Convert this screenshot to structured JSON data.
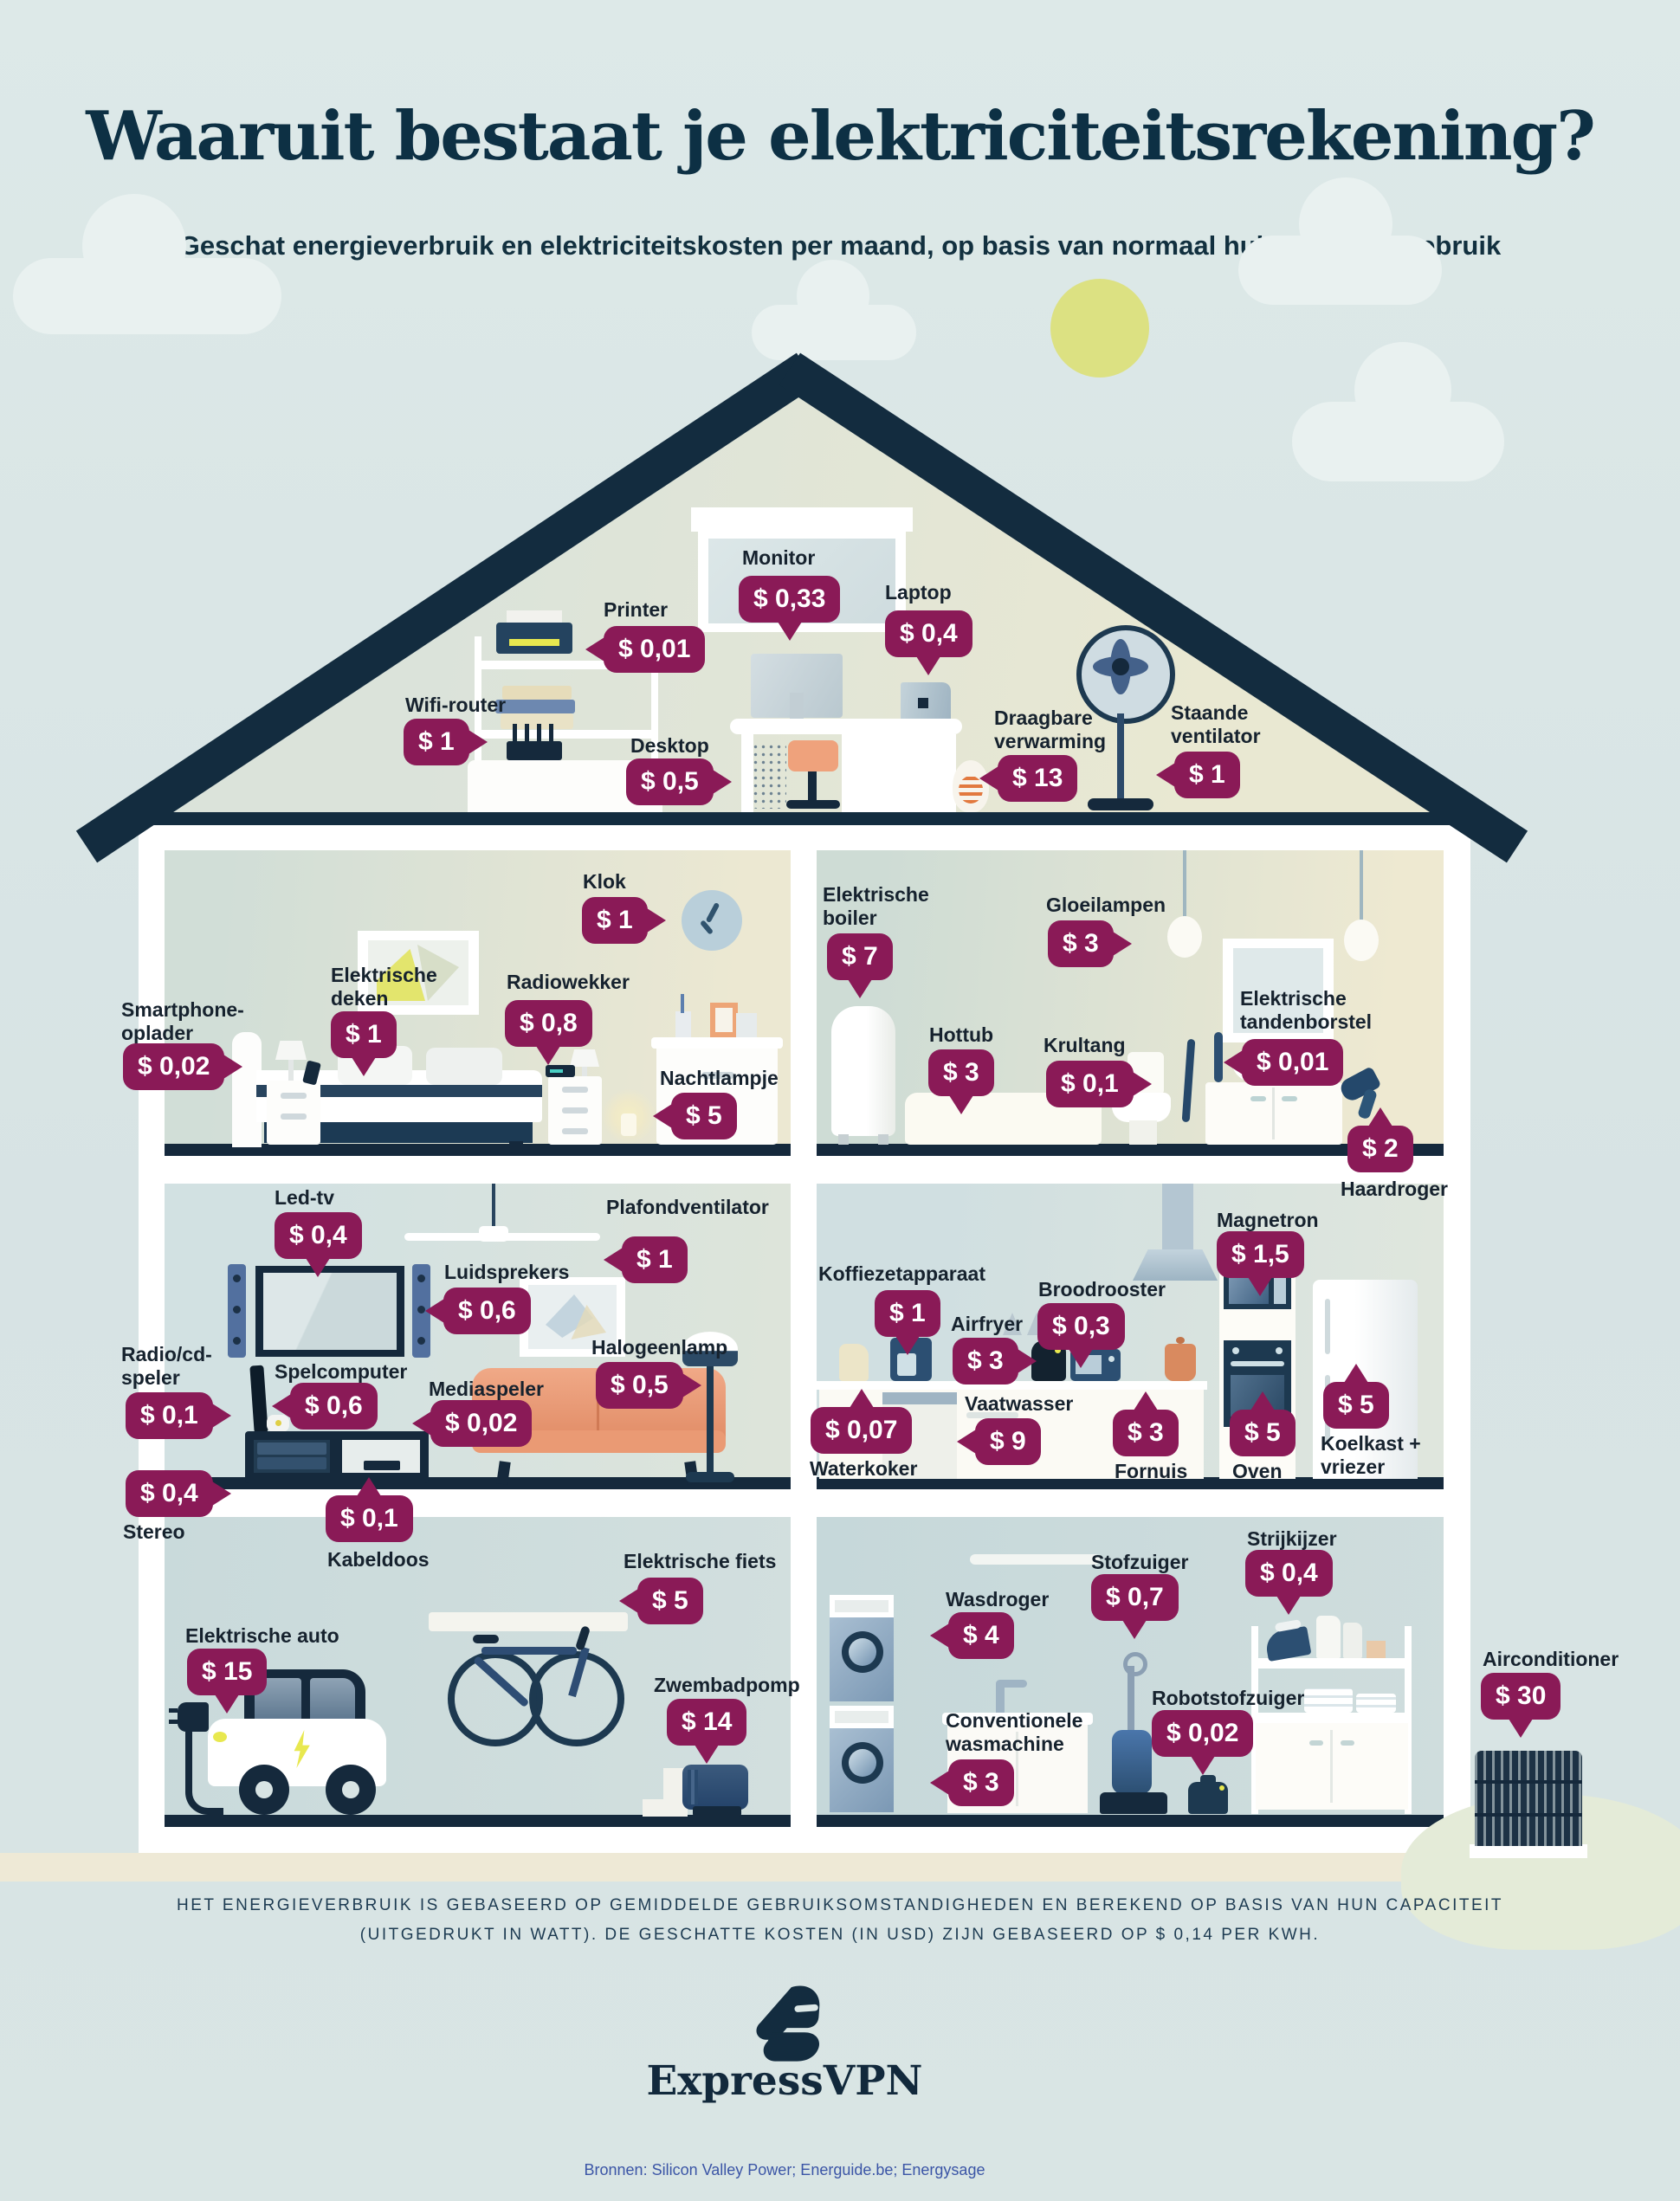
{
  "title": "Waaruit bestaat je elektriciteitsrekening?",
  "subtitle": "Geschat energieverbruik en elektriciteitskosten per maand, op basis van normaal huishoudelijk gebruik",
  "colors": {
    "badge": "#8a1a57",
    "roof_navy": "#15293c",
    "sun": "#dce182",
    "title": "#0d3044",
    "sources_blue": "#3b55a6"
  },
  "appliances": [
    {
      "label": "Printer",
      "price": "$ 0,01"
    },
    {
      "label": "Monitor",
      "price": "$ 0,33"
    },
    {
      "label": "Laptop",
      "price": "$ 0,4"
    },
    {
      "label": "Wifi-router",
      "price": "$ 1"
    },
    {
      "label": "Desktop",
      "price": "$ 0,5"
    },
    {
      "label": "Draagbare\nverwarming",
      "price": "$ 13"
    },
    {
      "label": "Staande\nventilator",
      "price": "$ 1"
    },
    {
      "label": "Klok",
      "price": "$ 1"
    },
    {
      "label": "Elektrische\ndeken",
      "price": "$ 1"
    },
    {
      "label": "Radiowekker",
      "price": "$ 0,8"
    },
    {
      "label": "Smartphone-\noplader",
      "price": "$ 0,02"
    },
    {
      "label": "Nachtlampje",
      "price": "$ 5"
    },
    {
      "label": "Elektrische\nboiler",
      "price": "$ 7"
    },
    {
      "label": "Gloeilampen",
      "price": "$ 3"
    },
    {
      "label": "Hottub",
      "price": "$ 3"
    },
    {
      "label": "Krultang",
      "price": "$ 0,1"
    },
    {
      "label": "Elektrische\ntandenborstel",
      "price": "$ 0,01"
    },
    {
      "label": "Haardroger",
      "price": "$ 2"
    },
    {
      "label": "Led-tv",
      "price": "$ 0,4"
    },
    {
      "label": "Plafondventilator",
      "price": "$ 1"
    },
    {
      "label": "Luidsprekers",
      "price": "$ 0,6"
    },
    {
      "label": "Halogeenlamp",
      "price": "$ 0,5"
    },
    {
      "label": "Radio/cd-\nspeler",
      "price": "$ 0,1"
    },
    {
      "label": "Spelcomputer",
      "price": "$ 0,6"
    },
    {
      "label": "Mediaspeler",
      "price": "$ 0,02"
    },
    {
      "label": "Stereo",
      "price": "$ 0,4"
    },
    {
      "label": "Kabeldoos",
      "price": "$ 0,1"
    },
    {
      "label": "Koffiezetapparaat",
      "price": "$ 1"
    },
    {
      "label": "Broodrooster",
      "price": "$ 0,3"
    },
    {
      "label": "Magnetron",
      "price": "$ 1,5"
    },
    {
      "label": "Airfryer",
      "price": "$ 3"
    },
    {
      "label": "Waterkoker",
      "price": "$ 0,07"
    },
    {
      "label": "Vaatwasser",
      "price": "$ 9"
    },
    {
      "label": "Fornuis",
      "price": "$ 3"
    },
    {
      "label": "Oven",
      "price": "$ 5"
    },
    {
      "label": "Koelkast +\nvriezer",
      "price": "$ 5"
    },
    {
      "label": "Elektrische auto",
      "price": "$ 15"
    },
    {
      "label": "Elektrische fiets",
      "price": "$ 5"
    },
    {
      "label": "Zwembadpomp",
      "price": "$ 14"
    },
    {
      "label": "Wasdroger",
      "price": "$ 4"
    },
    {
      "label": "Stofzuiger",
      "price": "$ 0,7"
    },
    {
      "label": "Strijkijzer",
      "price": "$ 0,4"
    },
    {
      "label": "Conventionele\nwasmachine",
      "price": "$ 3"
    },
    {
      "label": "Robotstofzuiger",
      "price": "$ 0,02"
    },
    {
      "label": "Airconditioner",
      "price": "$ 30"
    }
  ],
  "footer": {
    "disclaimer_line1": "HET ENERGIEVERBRUIK IS GEBASEERD OP GEMIDDELDE GEBRUIKSOMSTANDIGHEDEN EN BEREKEND OP BASIS VAN HUN CAPACITEIT",
    "disclaimer_line2": "(UITGEDRUKT IN WATT). DE GESCHATTE KOSTEN (IN USD) ZIJN GEBASEERD OP $ 0,14 PER KWH.",
    "brand": "ExpressVPN",
    "sources": "Bronnen: Silicon Valley Power; Energuide.be; Energysage"
  }
}
